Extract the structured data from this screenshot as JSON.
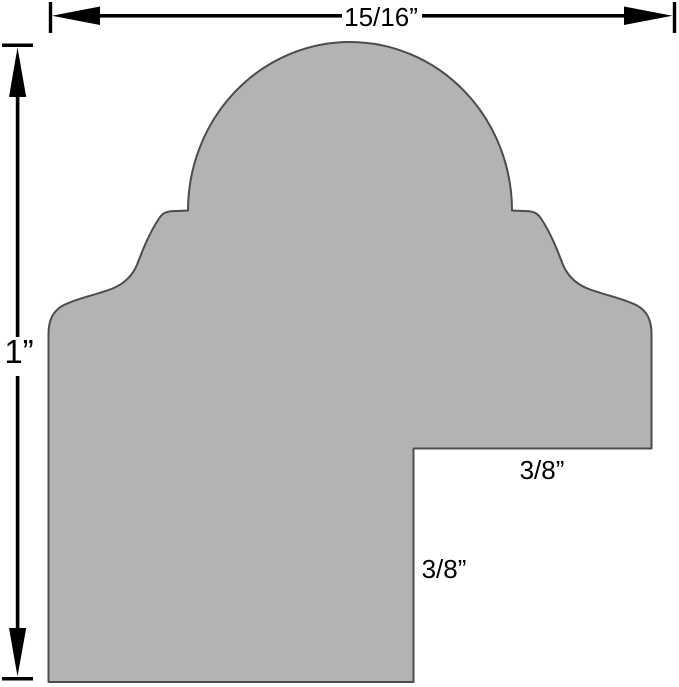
{
  "diagram": {
    "kind": "moulding-profile-cross-section",
    "colors": {
      "background": "#ffffff",
      "shape_fill": "#b3b3b3",
      "shape_outline": "#4c4c4c",
      "dimension": "#000000"
    },
    "dimensions": {
      "overall_width": {
        "label": "15/16”"
      },
      "overall_height": {
        "label": "1”"
      },
      "rabbet_width": {
        "label": "3/8”"
      },
      "rabbet_depth": {
        "label": "3/8”"
      }
    }
  }
}
